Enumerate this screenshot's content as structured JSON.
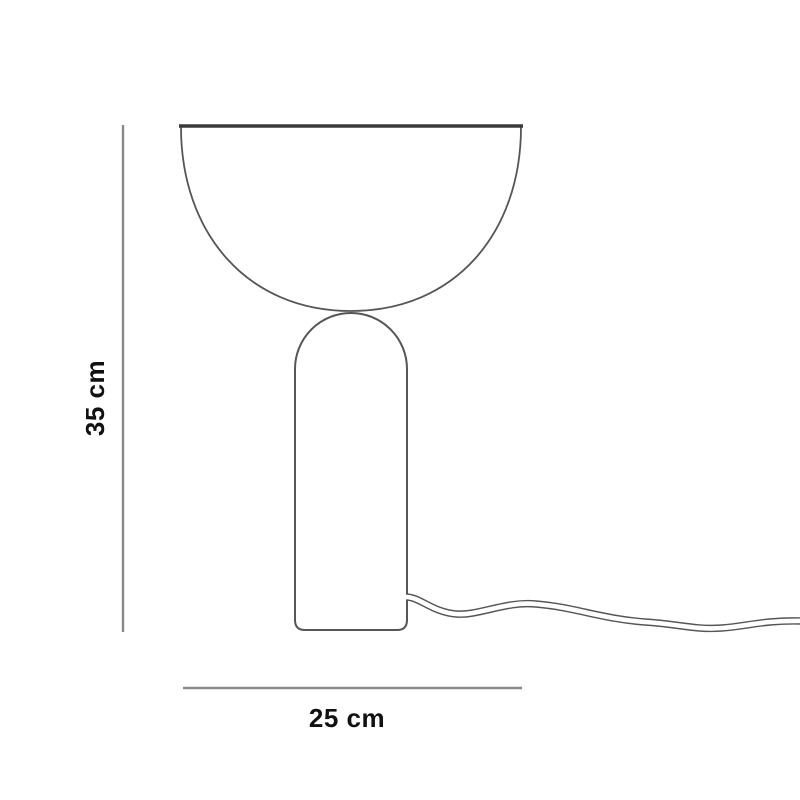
{
  "labels": {
    "height": "35 cm",
    "width": "25 cm"
  },
  "colors": {
    "background": "#ffffff",
    "outline": "#565656",
    "shade_top_edge": "#3a3a3a",
    "dimension_line": "#898989",
    "label_text": "#111111"
  }
}
